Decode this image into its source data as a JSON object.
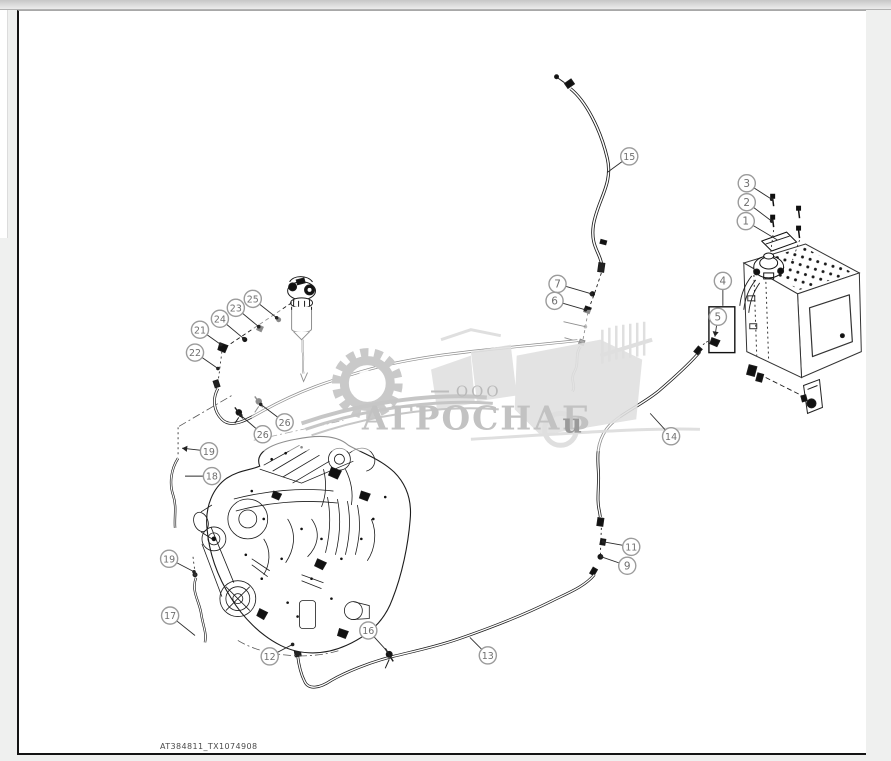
{
  "page": {
    "footer_code": "AT384811_TX1074908"
  },
  "watermark": {
    "prefix": "ООО",
    "company": "АГРОСНАБ",
    "suffix": "u"
  },
  "colors": {
    "linework": "#1c1c1c",
    "callout_ring": "#9b9b9b",
    "callout_text": "#6f6f6f",
    "watermark_gray": "#c8c8c8",
    "page_background": "#eff0ef"
  },
  "callouts": [
    {
      "n": "15",
      "x": 629,
      "y": 156,
      "tx": 607,
      "ty": 172,
      "dot": false,
      "arrow": false
    },
    {
      "n": "3",
      "x": 747,
      "y": 183,
      "tx": 772,
      "ty": 199,
      "dot": true,
      "arrow": false
    },
    {
      "n": "2",
      "x": 747,
      "y": 202,
      "tx": 772,
      "ty": 221,
      "dot": true,
      "arrow": false
    },
    {
      "n": "1",
      "x": 746,
      "y": 221,
      "tx": 778,
      "ty": 240,
      "dot": false,
      "arrow": false
    },
    {
      "n": "4",
      "x": 723,
      "y": 281,
      "tx": 723,
      "ty": 306,
      "dot": false,
      "arrow": false
    },
    {
      "n": "5",
      "x": 718,
      "y": 317,
      "tx": 715,
      "ty": 337,
      "dot": false,
      "arrow": true
    },
    {
      "n": "7",
      "x": 557,
      "y": 284,
      "tx": 591,
      "ty": 294,
      "dot": true,
      "arrow": false
    },
    {
      "n": "6",
      "x": 554,
      "y": 301,
      "tx": 585,
      "ty": 310,
      "dot": true,
      "arrow": false
    },
    {
      "n": "14",
      "x": 671,
      "y": 437,
      "tx": 650,
      "ty": 414,
      "dot": false,
      "arrow": false
    },
    {
      "n": "11",
      "x": 631,
      "y": 548,
      "tx": 603,
      "ty": 543,
      "dot": true,
      "arrow": false
    },
    {
      "n": "9",
      "x": 627,
      "y": 567,
      "tx": 601,
      "ty": 558,
      "dot": true,
      "arrow": false
    },
    {
      "n": "13",
      "x": 487,
      "y": 657,
      "tx": 469,
      "ty": 639,
      "dot": false,
      "arrow": false
    },
    {
      "n": "16",
      "x": 367,
      "y": 632,
      "tx": 387,
      "ty": 654,
      "dot": false,
      "arrow": false
    },
    {
      "n": "12",
      "x": 268,
      "y": 658,
      "tx": 291,
      "ty": 646,
      "dot": true,
      "arrow": false
    },
    {
      "n": "17",
      "x": 168,
      "y": 617,
      "tx": 193,
      "ty": 637,
      "dot": false,
      "arrow": false
    },
    {
      "n": "19",
      "x": 167,
      "y": 560,
      "tx": 192,
      "ty": 573,
      "dot": true,
      "arrow": false
    },
    {
      "n": "18",
      "x": 210,
      "y": 477,
      "tx": 183,
      "ty": 477,
      "dot": false,
      "arrow": false
    },
    {
      "n": "19",
      "x": 207,
      "y": 452,
      "tx": 180,
      "ty": 449,
      "dot": false,
      "arrow": true
    },
    {
      "n": "21",
      "x": 198,
      "y": 330,
      "tx": 219,
      "ty": 345,
      "dot": true,
      "arrow": false
    },
    {
      "n": "22",
      "x": 193,
      "y": 353,
      "tx": 216,
      "ty": 369,
      "dot": true,
      "arrow": false
    },
    {
      "n": "24",
      "x": 218,
      "y": 319,
      "tx": 242,
      "ty": 339,
      "dot": true,
      "arrow": false
    },
    {
      "n": "23",
      "x": 234,
      "y": 308,
      "tx": 257,
      "ty": 327,
      "dot": true,
      "arrow": false
    },
    {
      "n": "25",
      "x": 251,
      "y": 299,
      "tx": 275,
      "ty": 318,
      "dot": true,
      "arrow": false
    },
    {
      "n": "26",
      "x": 283,
      "y": 423,
      "tx": 259,
      "ty": 405,
      "dot": true,
      "arrow": false
    },
    {
      "n": "26",
      "x": 261,
      "y": 435,
      "tx": 239,
      "ty": 416,
      "dot": true,
      "arrow": false
    }
  ]
}
